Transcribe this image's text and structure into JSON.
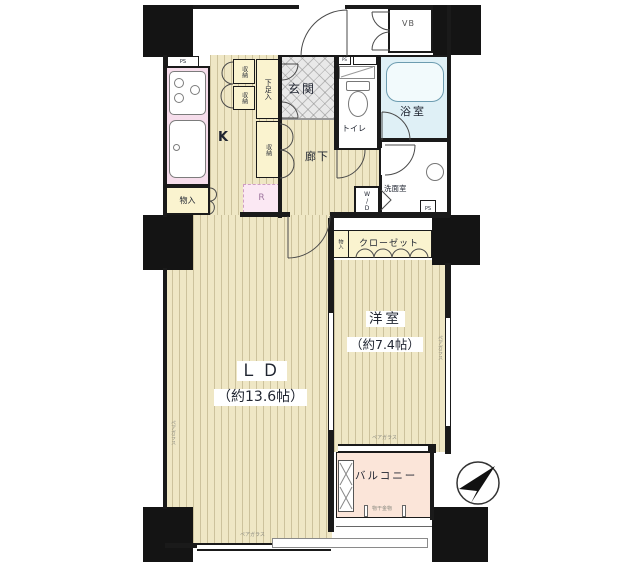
{
  "plan": {
    "rooms": {
      "ld": {
        "name": "ＬＤ",
        "size": "（約13.6帖）"
      },
      "western": {
        "name": "洋室",
        "size": "（約7.4帖）"
      },
      "kitchen": "K",
      "entrance": "玄関",
      "hallway": "廊下",
      "toilet": "トイレ",
      "bath": "浴室",
      "washroom": "洗面室",
      "balcony": "バルコニー",
      "closet": "クローゼット"
    },
    "storage": {
      "shoe": "下足入",
      "storage_a": "収納",
      "storage_b": "収納",
      "storage_c": "収納",
      "monoire": "物入",
      "monoire_small": "物入",
      "vb": "VB",
      "wd": "W/D",
      "fridge": "R",
      "ps_top": "PS",
      "ps_toilet": "PS",
      "ps_right": "PS"
    },
    "annotations": {
      "window_left": "ペアガラス",
      "window_bottom": "ペアガラス",
      "window_west_room": "ペアガラス",
      "window_balcony": "ペアガラス",
      "laundry": "物干金物"
    },
    "colors": {
      "wall": "#1a1a1a",
      "floor": "#efe7c5",
      "kitchen_pink": "#f6ddeb",
      "bath_blue": "#dff0f6",
      "closet_cream": "#faf3cf",
      "balcony_peach": "#fbe5d9",
      "entrance_tile": "#e9e9e9"
    }
  }
}
